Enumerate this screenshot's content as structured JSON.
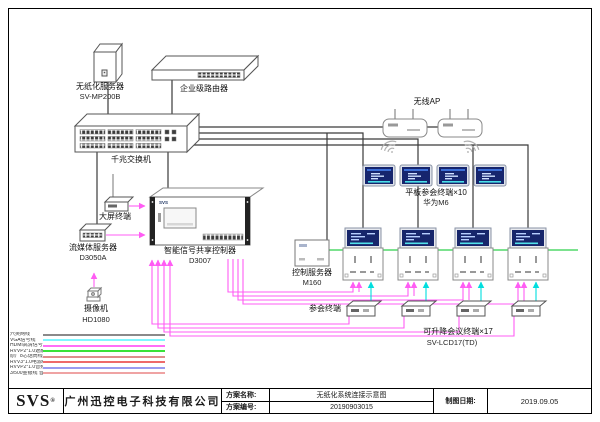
{
  "diagram_title": "无纸化系统连接示意图",
  "devices": {
    "paperless_server": {
      "name": "无纸化服务器",
      "model": "SV-MP200B"
    },
    "router": {
      "name": "企业级路由器"
    },
    "gigabit_switch": {
      "name": "千兆交换机"
    },
    "large_screen_terminal": {
      "name": "大屏终端"
    },
    "signal_controller": {
      "name": "智能信号共享控制器",
      "model": "D3007",
      "faceplate": "SVS"
    },
    "streaming_server": {
      "name": "流媒体服务器",
      "model": "D3050A"
    },
    "camera": {
      "name": "摄像机",
      "model": "HD1080"
    },
    "wireless_ap": {
      "name": "无线AP"
    },
    "tablet_terminals": {
      "name": "平板参会终端×10",
      "model": "华为M6"
    },
    "control_server": {
      "name": "控制服务器",
      "model": "M160"
    },
    "attendee_terminal": {
      "name": "参会终端"
    },
    "lift_terminals": {
      "name": "可升降会议终端×17",
      "model": "SV-LCD17(TD)"
    }
  },
  "legend": {
    "items": [
      {
        "label": "六类网线",
        "color": "#8a8a8a"
      },
      {
        "label": "VGA信号线",
        "color": "#7ff7ff"
      },
      {
        "label": "HDMI高清信号线",
        "color": "#ff6ef8"
      },
      {
        "label": "RVVP2*1.0遮蔽控制线",
        "color": "#3ae23a"
      },
      {
        "label": "原厂8芯话筒线",
        "color": "#df8d8d"
      },
      {
        "label": "RVV3*1.0电源线",
        "color": "#ee6a6a"
      },
      {
        "label": "RVVP2*1.0音频线",
        "color": "#9b9bf0"
      },
      {
        "label": "3/500金银线 音箱线",
        "color": "#efa3a3"
      }
    ]
  },
  "wire_colors": {
    "network_black": "#3a3a3a",
    "control_green": "#2fd04c",
    "hdmi_pink": "#ff5cf4",
    "signal_cyan": "#00dede"
  },
  "title_block": {
    "logo": "SVS",
    "logo_mark": "®",
    "company": "广州迅控电子科技有限公司",
    "scheme_name_label": "方案名称:",
    "scheme_name": "无纸化系统连接示意图",
    "scheme_no_label": "方案编号:",
    "scheme_no": "20190903015",
    "date_label": "制图日期:",
    "date": "2019.09.05"
  }
}
